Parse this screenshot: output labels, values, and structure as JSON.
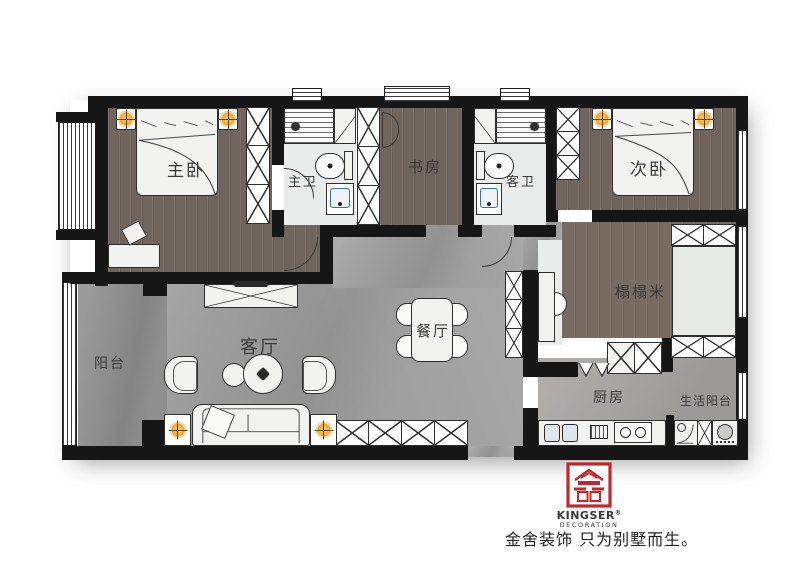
{
  "rooms": {
    "master_bedroom": "主卧",
    "master_bath": "主卫",
    "study": "书房",
    "guest_bath": "客卫",
    "second_bedroom": "次卧",
    "tatami": "榻榻米",
    "balcony": "阳台",
    "living_room": "客厅",
    "dining_room": "餐厅",
    "kitchen": "厨房",
    "service_balcony": "生活阳台"
  },
  "brand": {
    "name": "KINGSER",
    "reg": "®",
    "division": "DECORATION",
    "slogan": "金舍装饰 只为别墅而生。"
  },
  "palette": {
    "wall": "#161616",
    "wood_floor": "#6f655d",
    "marble_floor": "#9d9d9d",
    "bath_floor": "#eaeceb",
    "kitchen_floor": "#a6a4a1",
    "lamp_accent": "#f2a93b",
    "brand_red": "#c6262b"
  }
}
